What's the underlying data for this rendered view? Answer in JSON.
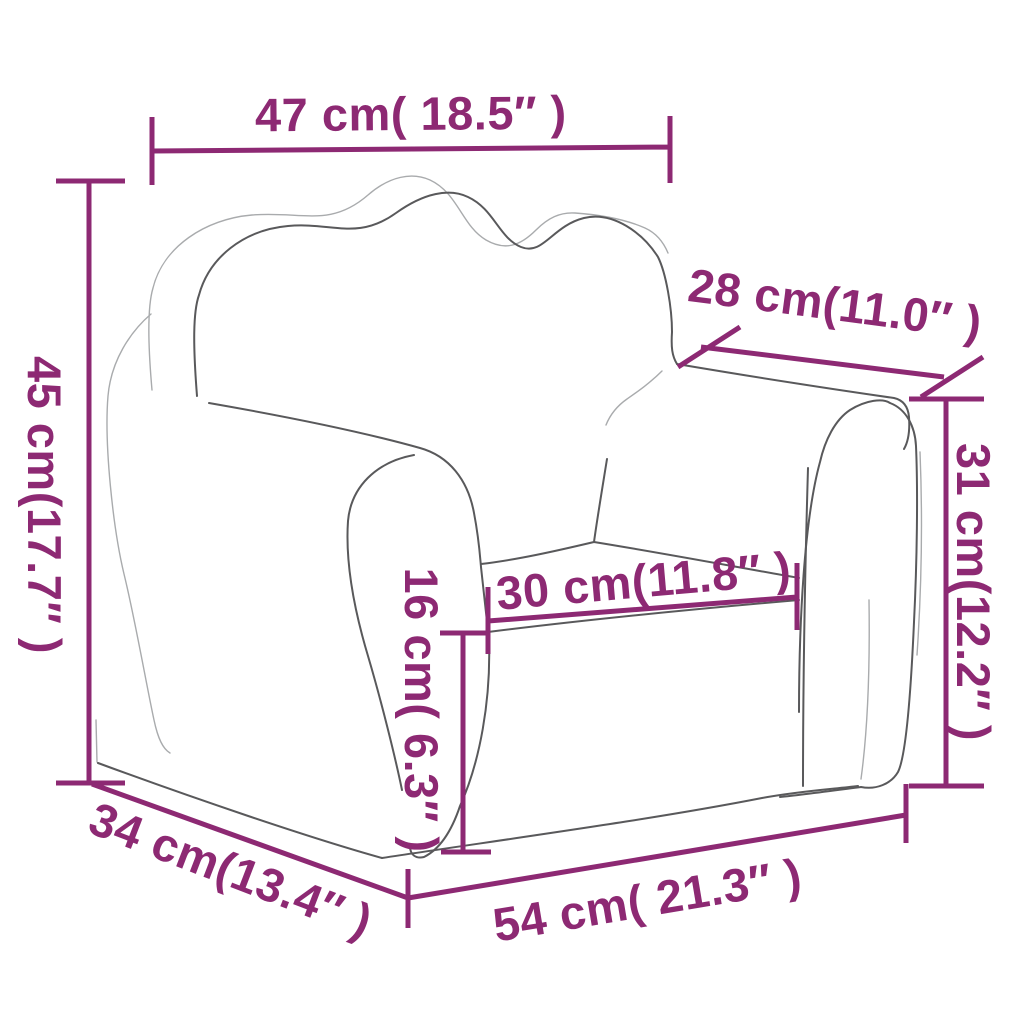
{
  "diagram": {
    "title": "kids-armchair-dimension-diagram",
    "accent_color": "#8d2973",
    "outline_color_front": "#59595b",
    "outline_color_back": "#a9abad",
    "background_color": "#ffffff",
    "unit_primary": "cm",
    "unit_secondary": "inches",
    "dimensions": {
      "top_width": {
        "label": "47 cm( 18.5″ )",
        "cm": 47,
        "inches": 18.5
      },
      "left_height": {
        "label": "45 cm(17.7″ )",
        "cm": 45,
        "inches": 17.7
      },
      "top_right_depth": {
        "label": "28 cm(11.0″ )",
        "cm": 28,
        "inches": 11.0
      },
      "right_height": {
        "label": "31 cm(12.2″ )",
        "cm": 31,
        "inches": 12.2
      },
      "seat_width": {
        "label": "30 cm(11.8″ )",
        "cm": 30,
        "inches": 11.8
      },
      "seat_height": {
        "label": "16 cm( 6.3″ )",
        "cm": 16,
        "inches": 6.3
      },
      "bottom_left_depth": {
        "label": "34 cm(13.4″ )",
        "cm": 34,
        "inches": 13.4
      },
      "bottom_width": {
        "label": "54 cm( 21.3″ )",
        "cm": 54,
        "inches": 21.3
      }
    }
  }
}
